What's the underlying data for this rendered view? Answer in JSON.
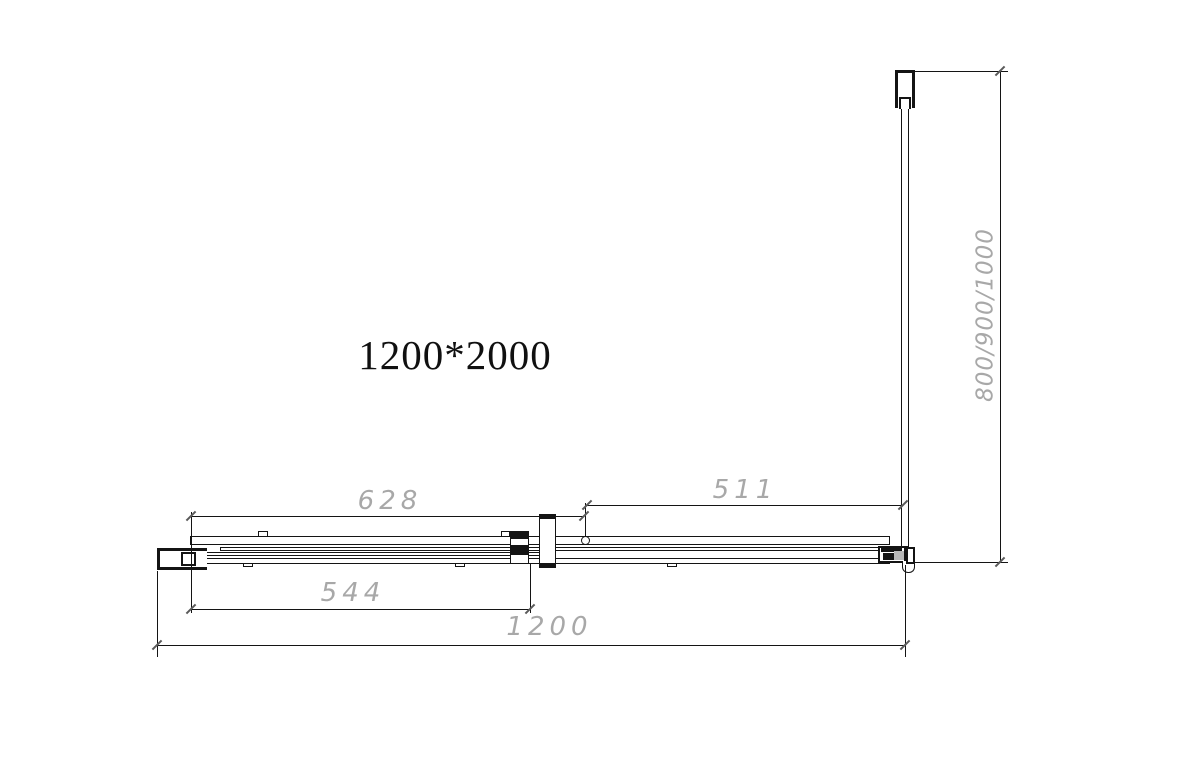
{
  "drawing": {
    "title": "1200*2000",
    "dims": {
      "track_width": "628",
      "fixed_panel_width": "511",
      "door_glass_width": "544",
      "overall_width": "1200",
      "side_panel_depth": "800/900/1000"
    },
    "colors": {
      "line": "#141414",
      "dim_text": "#a8a8a8",
      "tick": "#5a5a5a"
    }
  }
}
